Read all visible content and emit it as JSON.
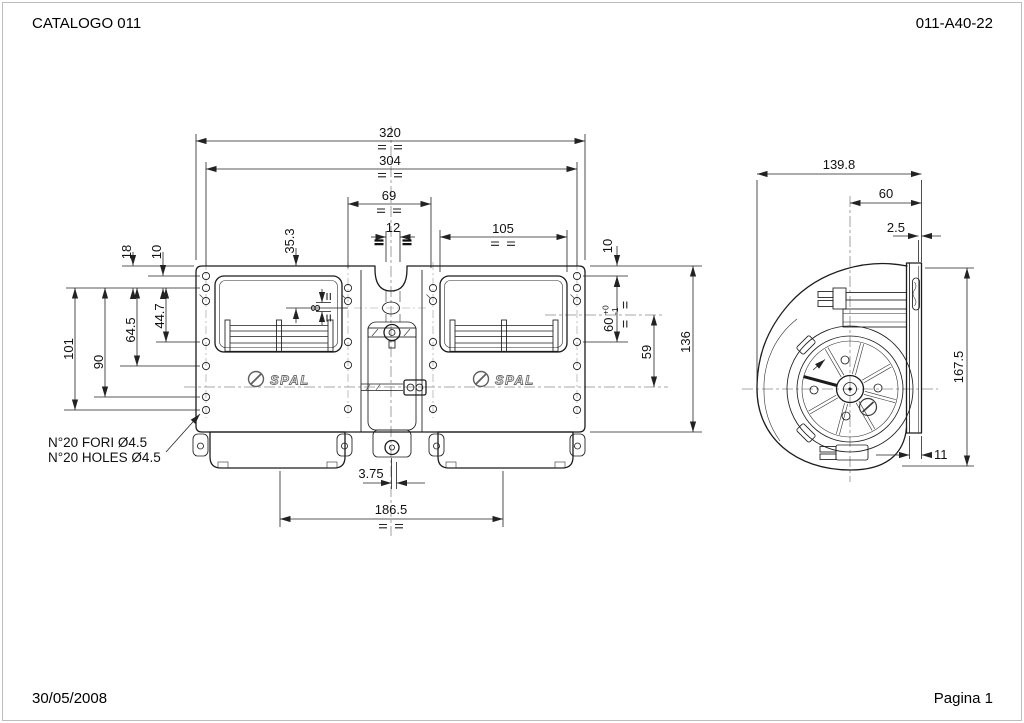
{
  "page": {
    "header_left": "CATALOGO 011",
    "header_right": "011-A40-22",
    "footer_left": "30/05/2008",
    "footer_right": "Pagina 1"
  },
  "note": {
    "line1": "N°20 FORI Ø4.5",
    "line2": "N°20 HOLES Ø4.5"
  },
  "brand": {
    "logo": "SPAL"
  },
  "front_view": {
    "dims": {
      "overall_width": "320",
      "hole_span_width": "304",
      "bracket_span": "69",
      "tube_width": "12",
      "window_width": "105",
      "inlet_depth": "35.3",
      "left_top_18": "18",
      "left_top_10": "10",
      "left_101": "101",
      "left_90": "90",
      "left_64_5": "64.5",
      "left_44_7": "44.7",
      "center_8": "8",
      "right_10": "10",
      "right_60": "60",
      "right_60_tol_plus": "+0",
      "right_60_tol_minus": "-1",
      "right_59": "59",
      "right_136": "136",
      "bottom_offset": "3.75",
      "outlet_span": "186.5"
    }
  },
  "side_view": {
    "dims": {
      "depth": "139.8",
      "axis_to_flange": "60",
      "lip": "2.5",
      "height": "167.5",
      "flange_width": "11"
    }
  }
}
